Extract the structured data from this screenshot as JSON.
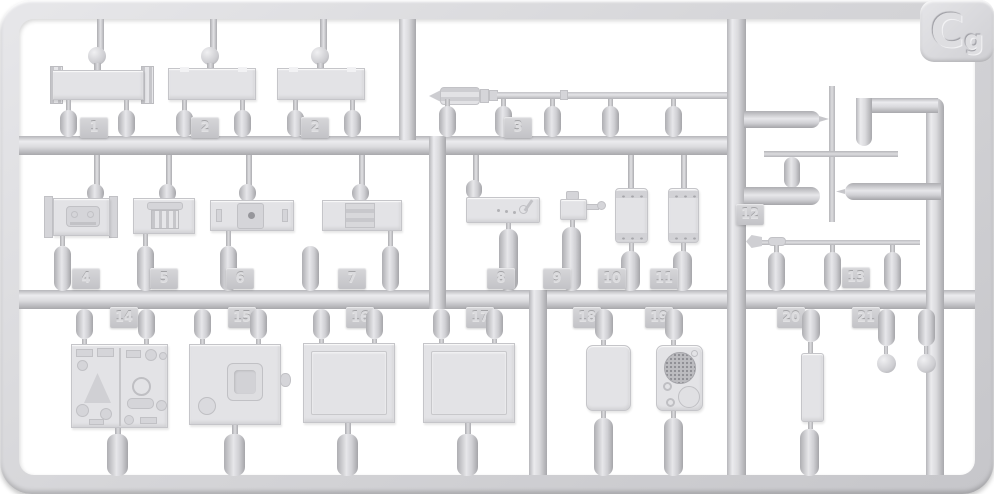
{
  "sheet": {
    "code_big": "C",
    "code_small": "g"
  },
  "colors": {
    "plastic": "#d6d6d9",
    "plastic_highlight": "#ebebee",
    "plastic_shadow": "#a8a8ac",
    "part_fill": "#e3e3e6",
    "background": "#ffffff"
  },
  "part_tabs": [
    {
      "label": "1"
    },
    {
      "label": "2"
    },
    {
      "label": "2"
    },
    {
      "label": "3"
    },
    {
      "label": "4"
    },
    {
      "label": "5"
    },
    {
      "label": "6"
    },
    {
      "label": "7"
    },
    {
      "label": "8"
    },
    {
      "label": "9"
    },
    {
      "label": "10"
    },
    {
      "label": "11"
    },
    {
      "label": "12"
    },
    {
      "label": "13"
    },
    {
      "label": "14"
    },
    {
      "label": "15"
    },
    {
      "label": "16"
    },
    {
      "label": "17"
    },
    {
      "label": "18"
    },
    {
      "label": "19"
    },
    {
      "label": "20"
    },
    {
      "label": "21"
    }
  ]
}
